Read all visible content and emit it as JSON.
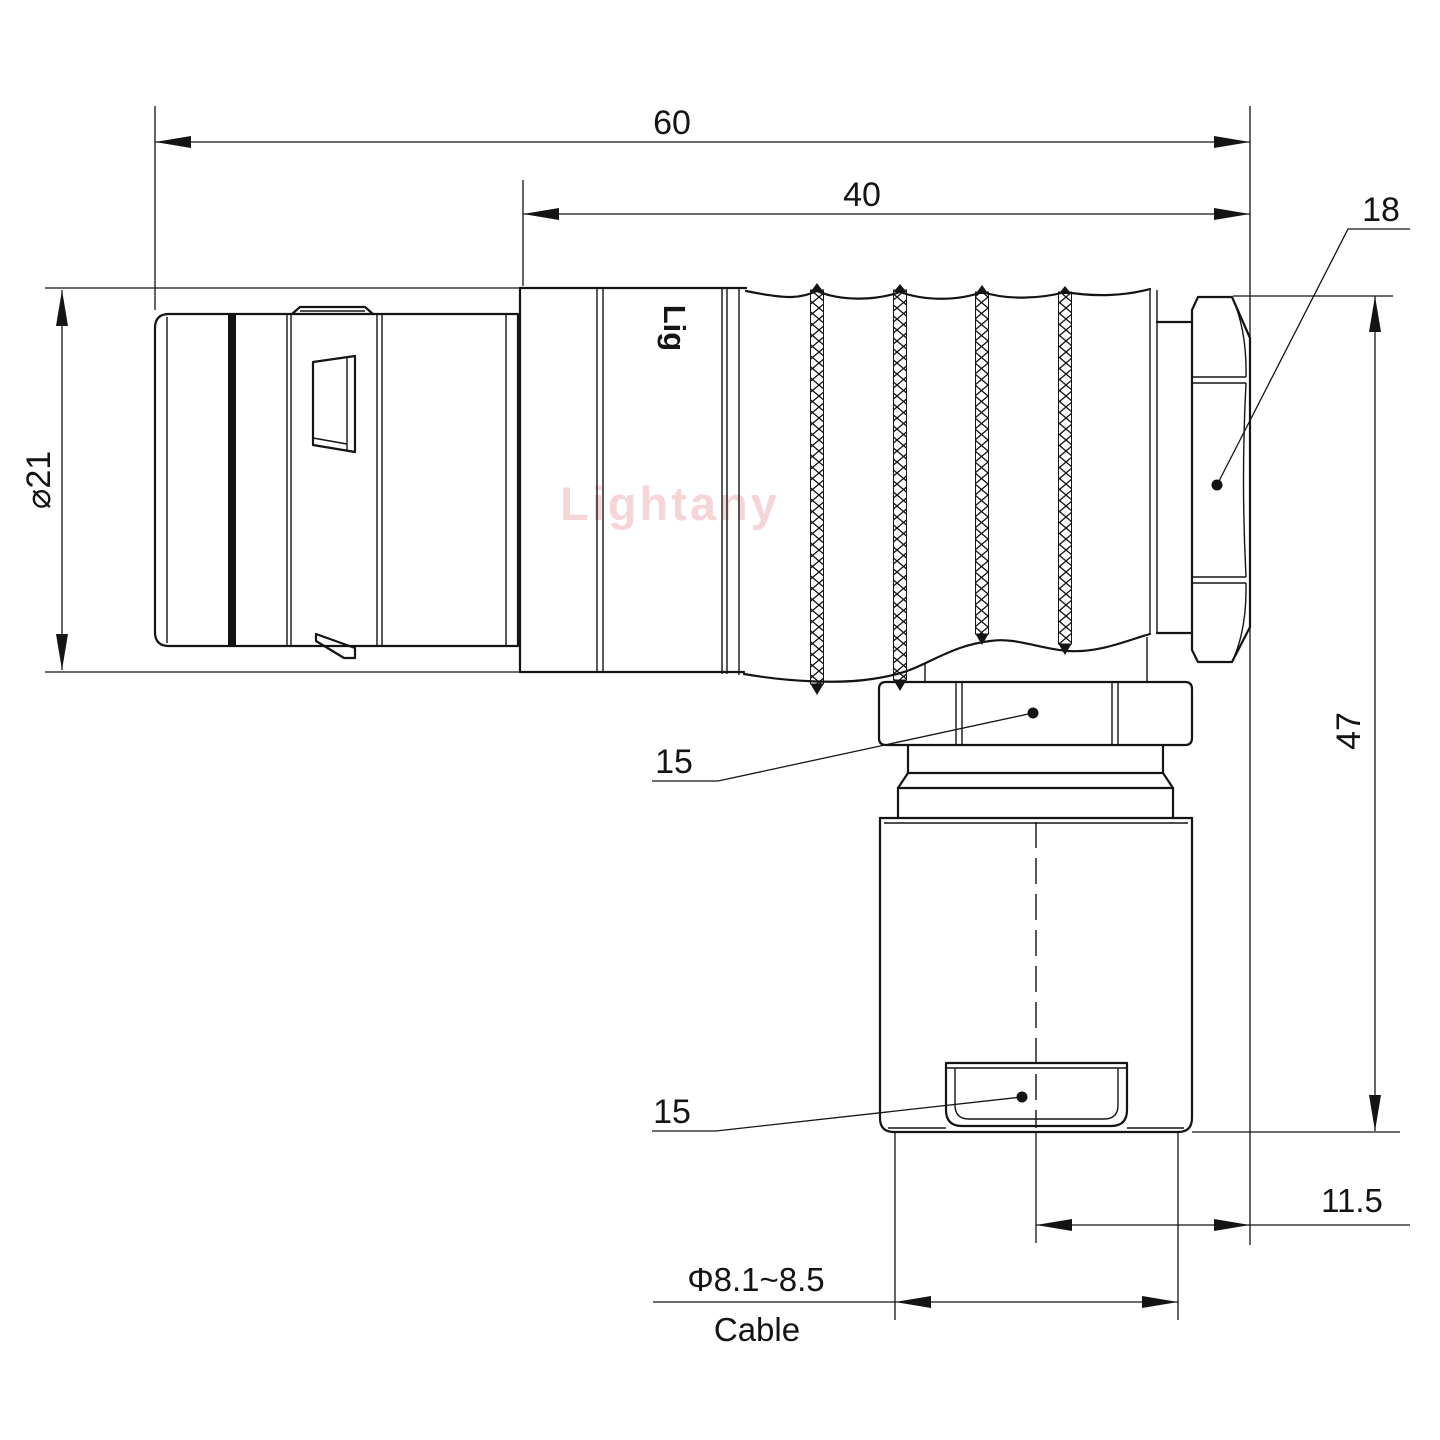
{
  "page": {
    "background": "#ffffff",
    "line_color": "#141414"
  },
  "watermark": {
    "text": "Lightany",
    "color": "#eeb4b4"
  },
  "brand_mark": {
    "text": "Lig"
  },
  "dimensions": {
    "overall_length": "60",
    "rear_length": "40",
    "backnut_size": "18",
    "shell_diameter": "⌀21",
    "overall_height": "47",
    "exit_offset": "11.5",
    "coupling_hex": "15",
    "clamp_hex": "15",
    "cable_diameter": "Φ8.1~8.5",
    "cable_label": "Cable"
  }
}
